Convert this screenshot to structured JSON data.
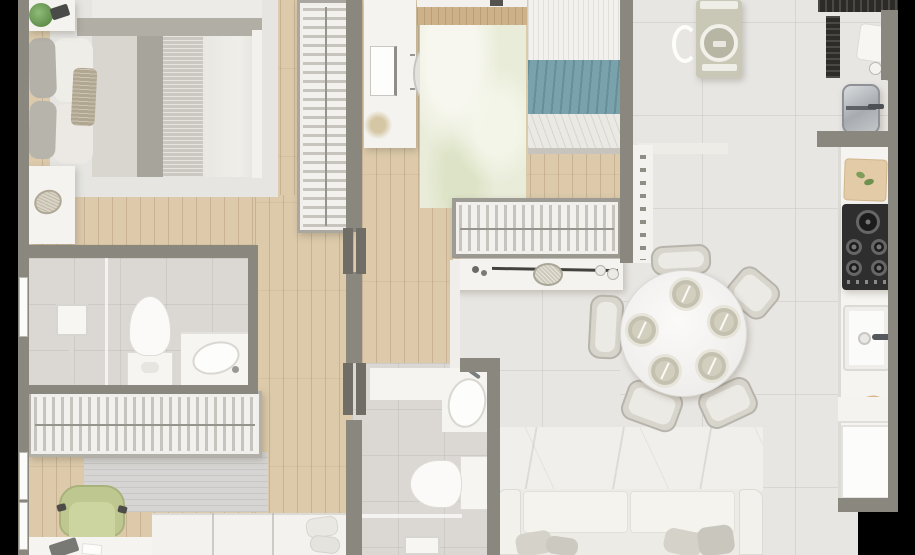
{
  "palette": {
    "bg": "#000000",
    "wall": "#8a887e",
    "wallDark": "#6f6d65",
    "wood": "#dccaab",
    "tile": "#e8e6e3",
    "tileBath": "#dbd8d3",
    "white": "#f4f3f0",
    "duvetGray": "#a7a49c",
    "teal": "#7aa2ac",
    "sage": "#c9c8b6",
    "chairGreen": "#bdc78f",
    "cooktop": "#2e2e2e",
    "plate": "#d2cfbe",
    "woodBand": "#ccb189"
  },
  "scene": {
    "type": "apartment-floor-plan-top-down-render",
    "rooms": [
      {
        "id": "bedroom-1",
        "items": [
          "double-bed",
          "gray-pillows",
          "duvet",
          "wall-shelf",
          "potted-plant",
          "tablet",
          "nightstand",
          "decor-plate",
          "area-rug",
          "wardrobe"
        ]
      },
      {
        "id": "bedroom-2",
        "items": [
          "desk",
          "monitor",
          "desk-chair",
          "dried-plant",
          "patterned-rug",
          "wood-band",
          "single-bed",
          "teal-blanket",
          "wardrobe"
        ]
      },
      {
        "id": "bathroom-1",
        "items": [
          "window",
          "shower-column",
          "glass-partition",
          "toilet",
          "vanity-sink",
          "faucet"
        ]
      },
      {
        "id": "bathroom-2",
        "items": [
          "vanity-sink",
          "faucet",
          "toilet",
          "glass-partition",
          "shower-head"
        ]
      },
      {
        "id": "office-bedroom-3",
        "items": [
          "wardrobe",
          "rug",
          "office-chair",
          "desk",
          "laptop",
          "papers",
          "single-bed",
          "pillows",
          "windows"
        ]
      },
      {
        "id": "service-area",
        "items": [
          "washing-machine",
          "laundry-basket",
          "jar-shelf",
          "counter-bar",
          "drying-rack",
          "board",
          "bowls",
          "laundry-sink"
        ]
      },
      {
        "id": "kitchen",
        "items": [
          "counter",
          "cutting-board",
          "vegetables",
          "cooktop-5-burners",
          "farmhouse-sink",
          "faucet",
          "bread",
          "lower-cabinet",
          "refrigerator"
        ]
      },
      {
        "id": "dining",
        "items": [
          "console-table",
          "decor-bowl",
          "decor-branch",
          "glasses",
          "round-table",
          "five-plates",
          "five-chairs"
        ]
      },
      {
        "id": "living",
        "items": [
          "marble-rug",
          "sofa",
          "armrests",
          "seat-cushions",
          "throw-pillows"
        ]
      }
    ]
  }
}
